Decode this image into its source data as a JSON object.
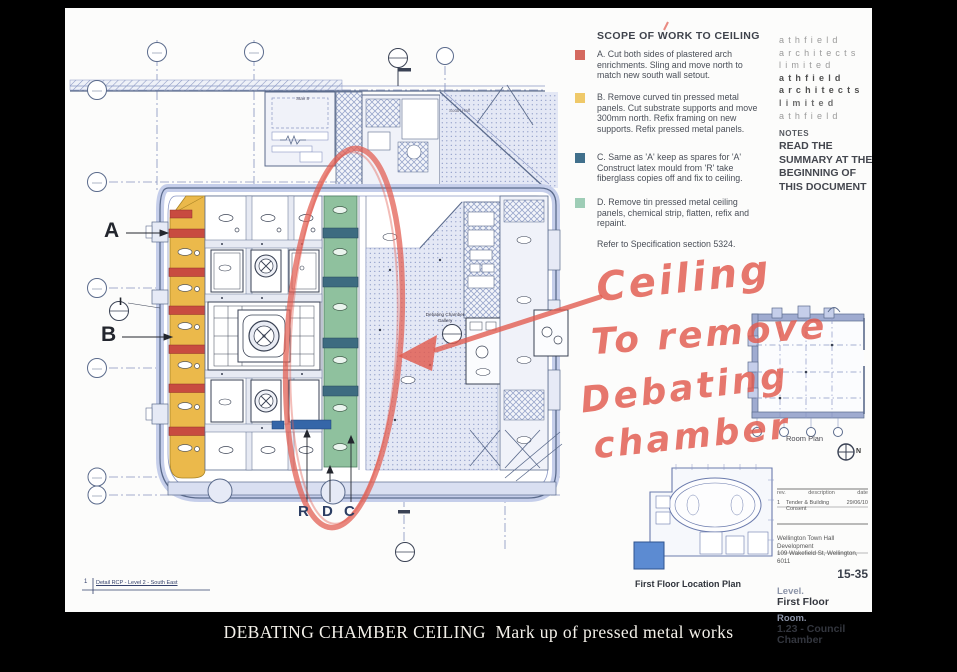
{
  "caption": "DEBATING CHAMBER CEILING  Mark up of pressed metal works",
  "scope": {
    "title": "SCOPE OF WORK TO CEILING",
    "items": [
      {
        "key": "A",
        "color": "#D4695F",
        "text": "A. Cut both sides of plastered arch enrichments. Sling and move north to match new south wall setout."
      },
      {
        "key": "B",
        "color": "#EFC969",
        "text": "B. Remove curved tin pressed metal panels. Cut substrate supports and move 300mm north. Refix framing on new supports. Refix pressed metal panels."
      },
      {
        "key": "C",
        "color": "#41708C",
        "text": "C. Same as 'A' keep as spares for 'A' Construct latex mould from 'R' take fiberglass copies off and fix to ceiling."
      },
      {
        "key": "D",
        "color": "#9ECDB6",
        "text": "D. Remove tin pressed metal ceiling panels, chemical strip, flatten, refix and repaint."
      }
    ],
    "refer": "Refer to Specification section 5324."
  },
  "logo": {
    "lines": [
      "athfield",
      "architects",
      "limited",
      "athfield",
      "architects",
      "limited",
      "athfield"
    ]
  },
  "notes": {
    "label": "NOTES",
    "text": "READ THE SUMMARY AT THE BEGINNING OF THIS DOCUMENT"
  },
  "handwriting": {
    "color": "#E25A4E",
    "lines": [
      "Ceiling",
      "To remove",
      "Debating",
      "chamber"
    ]
  },
  "plan": {
    "labels": {
      "a": "A",
      "b": "B",
      "i": "I",
      "r": "R",
      "d": "D",
      "c": "C",
      "stair": "Stair 8",
      "south_hall": "South Hall",
      "gallery": "Debating Chamber Gallery",
      "detail_num": "1",
      "detail_caption": "Detail RCP - Level 2 - South East"
    },
    "colors": {
      "plan_yellow": "#EBB94B",
      "plan_red": "#C84B40",
      "plan_green": "#8FC19E",
      "plan_teal": "#3D6B80",
      "plan_blue_bar": "#3566A8",
      "annotation_red": "#E25A4E",
      "highlight_blue": "#5C8BD2"
    }
  },
  "room_plan": {
    "label": "Room Plan",
    "north": "N"
  },
  "location_plan": {
    "label": "First Floor Location Plan"
  },
  "titleblock": {
    "rev_header": {
      "rev": "rev.",
      "description": "description",
      "date": "date"
    },
    "rev_row": {
      "rev": "1",
      "description": "Tender & Building Consent",
      "date": "29/06/10"
    },
    "project_line1": "Wellington Town Hall Development",
    "project_line2": "109 Wakefield St, Wellington, 6011",
    "sheet_no": "15-35",
    "level_label": "Level.",
    "level_value": "First Floor",
    "room_label": "Room.",
    "room_value": "1.23 - Council Chamber"
  }
}
